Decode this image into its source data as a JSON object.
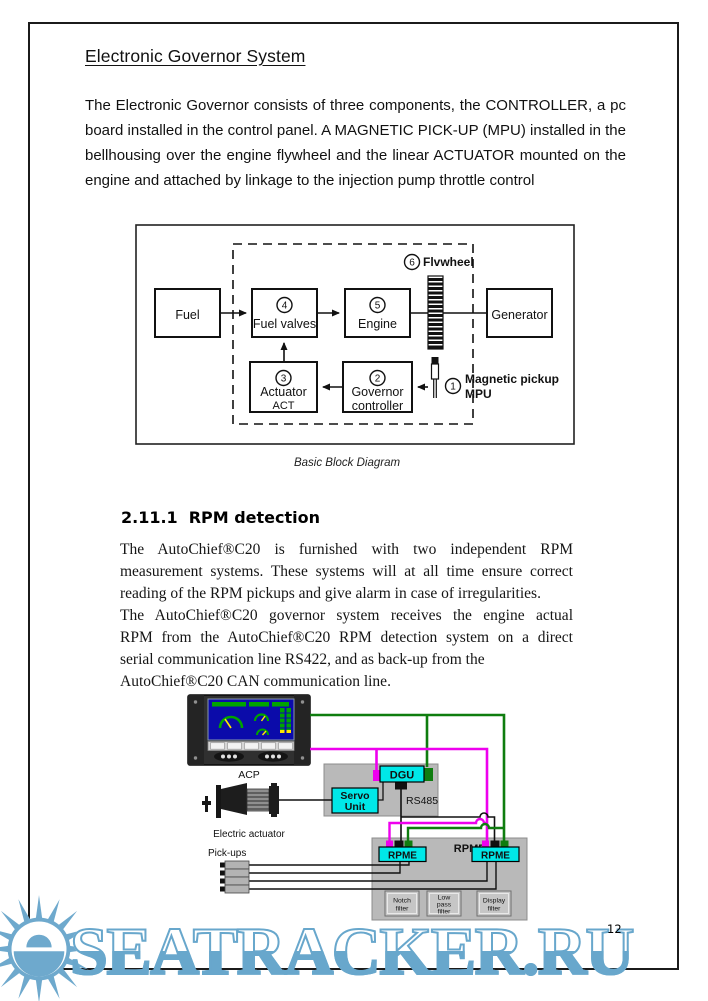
{
  "page": {
    "heading": "Electronic Governor System",
    "number": "12",
    "intro_lines": [
      "The Electronic Governor consists of three components, the CONTROLLER, a pc",
      "board installed in the control panel. A MAGNETIC PICK-UP (MPU) installed in the",
      "bellhousing over the engine flywheel and the linear ACTUATOR mounted on the",
      "engine and attached by linkage to the injection pump throttle control"
    ]
  },
  "diagram1": {
    "caption": "Basic Block Diagram",
    "fuel": "Fuel",
    "generator": "Generator",
    "fuel_valves": {
      "num": "4",
      "label": "Fuel valves"
    },
    "engine": {
      "num": "5",
      "label": "Engine"
    },
    "actuator": {
      "num": "3",
      "label": "Actuator",
      "sub": "ACT"
    },
    "governor": {
      "num": "2",
      "label": "Governor",
      "sub": "controller"
    },
    "flywheel": {
      "num": "6",
      "label": "Flvwheel"
    },
    "mpu": {
      "num": "1",
      "label": "Magnetic pickup",
      "sub": "MPU"
    }
  },
  "section": {
    "number": "2.11.1",
    "title": "RPM detection",
    "para1_lines": [
      "The AutoChief®C20 is furnished with two independent RPM",
      "measurement systems. These systems will at all time ensure correct",
      "reading of the RPM pickups and give alarm in case of irregularities."
    ],
    "para2_lines": [
      "The AutoChief®C20 governor system receives the engine actual",
      "RPM from the AutoChief®C20 RPM detection system on a direct",
      "serial communication line RS422, and as back-up from the",
      "AutoChief®C20 CAN communication line."
    ]
  },
  "diagram2": {
    "acp_label": "ACP",
    "actuator_label": "Electric actuator",
    "pickups_label": "Pick-ups",
    "dgu": "DGU",
    "servo": [
      "Servo",
      "Unit"
    ],
    "rs485": "RS485",
    "rpmd": "RPMD",
    "rpme_left": "RPME",
    "rpme_right": "RPME",
    "filter_notch": [
      "Notch",
      "filter"
    ],
    "filter_lowpass": [
      "Low",
      "pass",
      "filter"
    ],
    "filter_display": [
      "Display",
      "filter"
    ],
    "colors": {
      "wire_green": "#0f7d0f",
      "wire_magenta": "#ee00ee",
      "module_cyan": "#00e8e8",
      "panel_gray": "#b9b9b9"
    }
  },
  "watermark": {
    "text": "SEATRACKER.RU",
    "color": "#68a7cc"
  }
}
